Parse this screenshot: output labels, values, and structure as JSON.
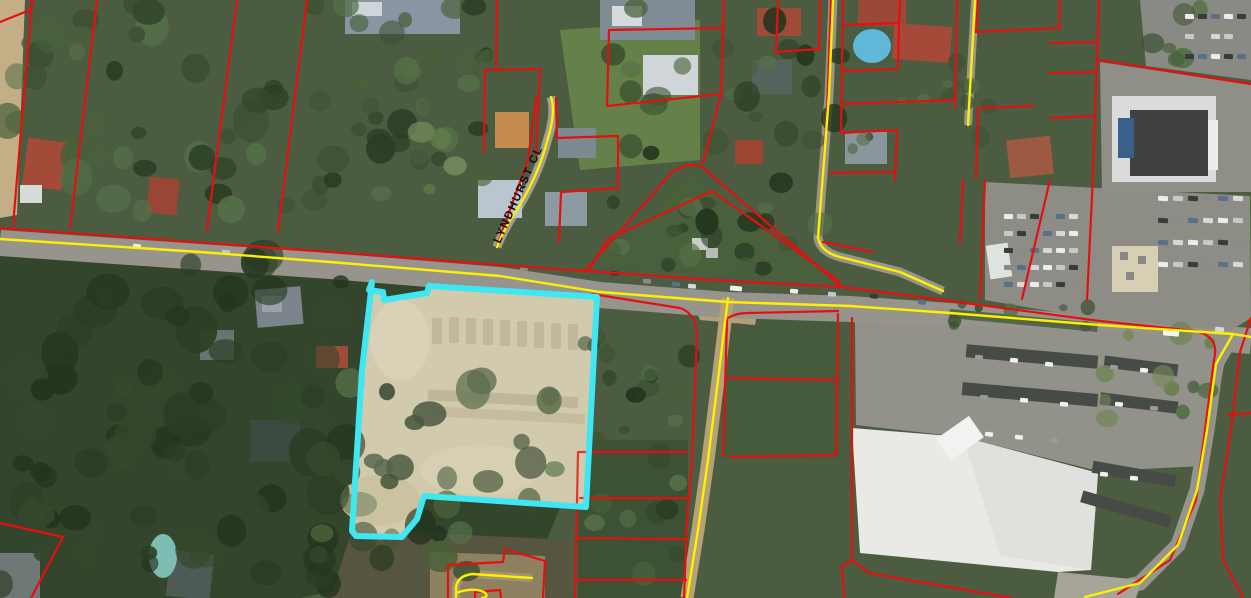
{
  "map": {
    "view": "satellite-with-cadastral-overlay",
    "street_label": "LYNDHURST CL",
    "label": {
      "x": 500,
      "y": 244,
      "rotation": -66,
      "font_size": 11.5,
      "letter_spacing": 1.4,
      "color": "#101010"
    },
    "colors": {
      "parcel_line": "#e60f0f",
      "road_centerline": "#fdf000",
      "highlight_stroke": "#3fe7f2"
    },
    "highlight_parcel": {
      "stroke_width": 6,
      "points": [
        [
          372,
          282
        ],
        [
          369,
          290
        ],
        [
          383,
          292
        ],
        [
          384,
          300
        ],
        [
          427,
          293
        ],
        [
          429,
          286
        ],
        [
          597,
          297
        ],
        [
          586,
          507
        ],
        [
          424,
          496
        ],
        [
          417,
          519
        ],
        [
          402,
          537
        ],
        [
          356,
          536
        ],
        [
          352,
          531
        ],
        [
          362,
          370
        ]
      ]
    },
    "parcel_lines": [
      "M32,0 L13,226",
      "M97,0 L70,228",
      "M237,0 L207,230",
      "M307,0 L278,232",
      "M0,22 L30,10 L33,0",
      "M0,228 L330,252 L500,265 L585,271 L730,281 L842,287 L950,301 L1100,321 L1195,331 Q1220,336 1214,360 L1205,430 L1196,500 L1170,560 L1118,594",
      "M585,271 L672,172 Q690,161 702,167 L842,287",
      "M590,268 L608,239 L712,191 L839,281",
      "M497,0 L496,70",
      "M485,70 L540,69",
      "M485,70 L484,152",
      "M540,69 L536,155",
      "M536,98 L528,160 L508,215 L497,246",
      "M556,98 L557,138 L618,136 L618,188",
      "M562,192 L618,188",
      "M561,192 L559,242",
      "M724,0 L721,94",
      "M609,30 L723,28",
      "M609,30 L607,106",
      "M607,106 L721,94",
      "M721,94 L703,163",
      "M778,0 L776,52 L820,49",
      "M820,0 L819,49",
      "M831,0 L827,113 L818,240",
      "M843,0 L841,133",
      "M900,0 L899,23",
      "M843,25 L899,23",
      "M899,23 L898,69",
      "M843,71 L898,69",
      "M957,0 L955,107",
      "M843,104 L955,100",
      "M841,133 L897,130 L895,180",
      "M830,173 L895,172",
      "M978,0 L976,32",
      "M976,32 L1060,28",
      "M1060,0 L1059,28",
      "M1050,43 L1097,42",
      "M1050,73 L1095,72",
      "M1050,118 L1093,116",
      "M1099,0 L1092,197 L1087,300",
      "M1098,60 L1251,84",
      "M978,108 L1033,106",
      "M978,108 L976,178",
      "M985,180 L980,299",
      "M1050,180 L1022,299",
      "M963,180 L960,242",
      "M823,242 L872,252",
      "M1251,318 L1240,352 L1231,430 L1220,500 L1223,560 L1243,598",
      "M1228,415 L1251,413",
      "M852,318 L852,560",
      "M838,314 L836,455",
      "M728,318 Q736,313 748,313 L838,311",
      "M727,320 L723,456",
      "M728,378 L836,380",
      "M730,457 L836,455",
      "M852,560 L842,566 L844,598",
      "M852,560 L869,573 L983,593 L1012,598",
      "M592,294 Q662,305 680,308 Q696,313 697,336 L692,460 L687,520 L684,598",
      "M579,452 L687,452",
      "M580,498 L687,498",
      "M578,538 L684,539",
      "M577,580 L686,580",
      "M578,452 L575,598",
      "M448,565 L448,598",
      "M448,565 L503,562 L505,549 L545,561 L543,598",
      "M475,598 L475,592 L500,590 L501,598",
      "M0,523 L63,537 L31,598"
    ],
    "road_centerlines": [
      "M0,239 L200,252 L330,262 L500,276 L600,292 L728,302 L850,306 L950,313 L1100,325 L1233,334 L1251,337",
      "M551,97 Q556,112 548,138 Q538,178 514,214 Q502,233 497,247",
      "M833,0 L829,95 L818,238 Q821,252 840,257 L900,272 L943,291",
      "M975,0 L968,125",
      "M728,298 L718,380 L708,460 L698,530 L687,598",
      "M532,578 L472,574 Q457,576 456,588 L456,598",
      "M456,593 Q472,587 484,592 Q490,597 482,598",
      "M1233,334 L1216,364 L1207,430 L1197,490 L1178,545 L1140,583 L1085,597"
    ]
  }
}
